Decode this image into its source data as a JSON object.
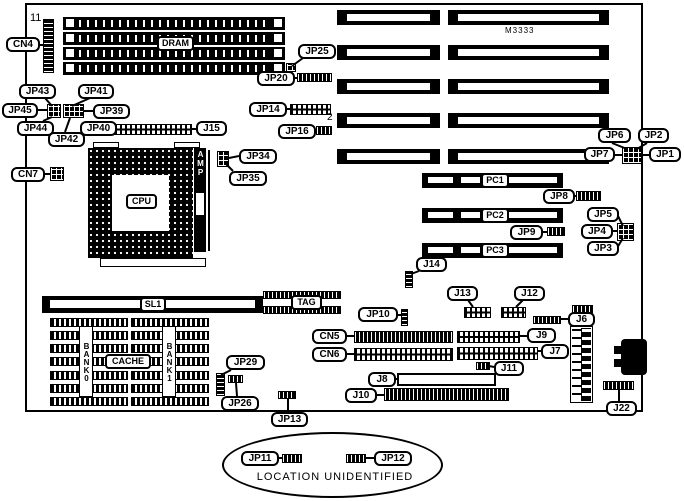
{
  "board": {
    "model": "M3333",
    "pin1_label": "11",
    "note_text": "LOCATION UNIDENTIFIED"
  },
  "components": {
    "dram": "DRAM",
    "cpu": "CPU",
    "amp": "AMP",
    "sl1": "SL1",
    "tag": "TAG",
    "cache": "CACHE",
    "bank0": "BANK0",
    "bank1": "BANK1",
    "pc1": "PC1",
    "pc2": "PC2",
    "pc3": "PC3",
    "jp14_pin2": "2"
  },
  "connectors": {
    "cn4": "CN4",
    "jp43": "JP43",
    "jp41": "JP41",
    "jp45": "JP45",
    "jp39": "JP39",
    "jp44": "JP44",
    "jp42": "JP42",
    "jp40": "JP40",
    "j15": "J15",
    "cn7": "CN7",
    "jp34": "JP34",
    "jp35": "JP35",
    "jp25": "JP25",
    "jp20": "JP20",
    "jp14": "JP14",
    "jp16": "JP16",
    "jp6": "JP6",
    "jp2": "JP2",
    "jp7": "JP7",
    "jp1": "JP1",
    "jp8": "JP8",
    "jp5": "JP5",
    "jp4": "JP4",
    "jp3": "JP3",
    "jp9": "JP9",
    "j14": "J14",
    "j13": "J13",
    "j12": "J12",
    "jp10": "JP10",
    "cn5": "CN5",
    "cn6": "CN6",
    "j9": "J9",
    "j6": "J6",
    "j7": "J7",
    "j11": "J11",
    "j8": "J8",
    "j10": "J10",
    "jp29": "JP29",
    "jp26": "JP26",
    "jp13": "JP13",
    "j22": "J22",
    "jp11": "JP11",
    "jp12": "JP12"
  }
}
